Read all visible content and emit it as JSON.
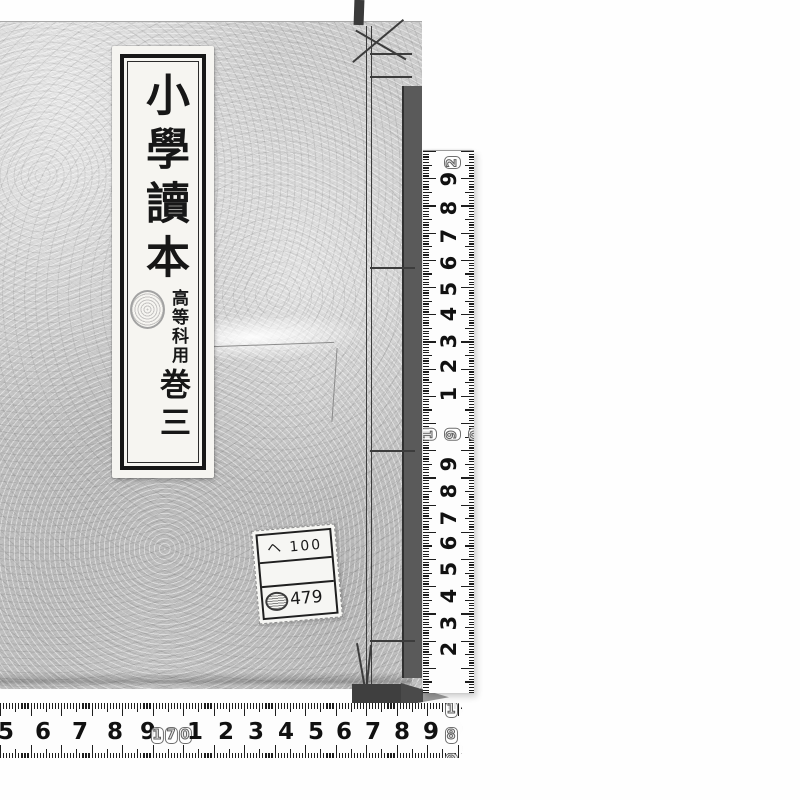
{
  "book": {
    "title_label": {
      "title": "小學讀本",
      "course_note": "高等科用",
      "volume": "巻三"
    },
    "library_label": {
      "row1": "ヘ 100",
      "row2": "",
      "row3_number": "479"
    }
  },
  "colors": {
    "cover": "#cfcfcf",
    "edge_shadow": "#5a5a5a",
    "label_paper": "#f6f5f1",
    "ink": "#171717",
    "tape": "#fdfdfd"
  },
  "rulers": {
    "unit": "cm",
    "vertical": {
      "orientation": "vertical",
      "numbers": [
        {
          "label": "2",
          "boxed": true,
          "pos": 12
        },
        {
          "label": "9",
          "boxed": false,
          "pos": 28
        },
        {
          "label": "8",
          "boxed": false,
          "pos": 57
        },
        {
          "label": "7",
          "boxed": false,
          "pos": 85
        },
        {
          "label": "6",
          "boxed": false,
          "pos": 112
        },
        {
          "label": "5",
          "boxed": false,
          "pos": 138
        },
        {
          "label": "4",
          "boxed": false,
          "pos": 163
        },
        {
          "label": "3",
          "boxed": false,
          "pos": 190
        },
        {
          "label": "2",
          "boxed": false,
          "pos": 215
        },
        {
          "label": "1",
          "boxed": false,
          "pos": 243
        },
        {
          "label": "190",
          "boxed": true,
          "pos": 278
        },
        {
          "label": "9",
          "boxed": false,
          "pos": 313
        },
        {
          "label": "8",
          "boxed": false,
          "pos": 340
        },
        {
          "label": "7",
          "boxed": false,
          "pos": 367
        },
        {
          "label": "6",
          "boxed": false,
          "pos": 392
        },
        {
          "label": "5",
          "boxed": false,
          "pos": 418
        },
        {
          "label": "4",
          "boxed": false,
          "pos": 445
        },
        {
          "label": "3",
          "boxed": false,
          "pos": 472
        },
        {
          "label": "2",
          "boxed": false,
          "pos": 498
        }
      ]
    },
    "horizontal": {
      "orientation": "horizontal",
      "numbers": [
        {
          "label": "5",
          "boxed": false,
          "pos": 6
        },
        {
          "label": "6",
          "boxed": false,
          "pos": 43
        },
        {
          "label": "7",
          "boxed": false,
          "pos": 80
        },
        {
          "label": "8",
          "boxed": false,
          "pos": 115
        },
        {
          "label": "9",
          "boxed": false,
          "pos": 148
        },
        {
          "label": "170",
          "boxed": true,
          "pos": 171
        },
        {
          "label": "1",
          "boxed": false,
          "pos": 195
        },
        {
          "label": "2",
          "boxed": false,
          "pos": 226
        },
        {
          "label": "3",
          "boxed": false,
          "pos": 256
        },
        {
          "label": "4",
          "boxed": false,
          "pos": 286
        },
        {
          "label": "5",
          "boxed": false,
          "pos": 316
        },
        {
          "label": "6",
          "boxed": false,
          "pos": 344
        },
        {
          "label": "7",
          "boxed": false,
          "pos": 373
        },
        {
          "label": "8",
          "boxed": false,
          "pos": 402
        },
        {
          "label": "9",
          "boxed": false,
          "pos": 431
        },
        {
          "label": "180",
          "boxed": true,
          "pos": 451
        }
      ]
    }
  }
}
